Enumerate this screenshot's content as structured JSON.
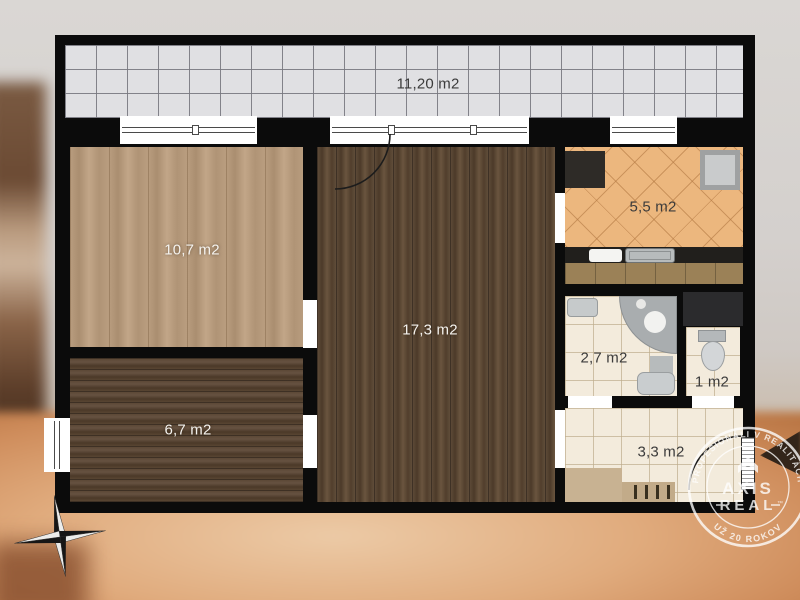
{
  "floorplan": {
    "rooms": {
      "balcony": {
        "label": "11,20 m2"
      },
      "bedroom": {
        "label": "10,7 m2"
      },
      "living_room": {
        "label": "17,3 m2"
      },
      "kitchen": {
        "label": "5,5 m2"
      },
      "bathroom": {
        "label": "2,7 m2"
      },
      "wc": {
        "label": "1 m2"
      },
      "hall": {
        "label": "3,3 m2"
      },
      "small_room": {
        "label": "6,7 m2"
      }
    },
    "colors": {
      "wall": "#0b0b0b",
      "balcony_tile": "#e0e0e3",
      "kitchen_tile": "#ecb77e",
      "ceramic_tile": "#f3ebdc",
      "wood_light": "#b49879",
      "wood_dark": "#57432f",
      "fixture_gray": "#b7bbbc",
      "wardrobe_tan": "#c8b292"
    }
  },
  "watermark": {
    "arc_top": "PROFESIONÁLI V REALITÁCH",
    "arc_bottom": "UŽ 20 ROKOV",
    "brand_line1": "AXIS",
    "brand_line2": "REAL",
    "trademark": "™"
  }
}
